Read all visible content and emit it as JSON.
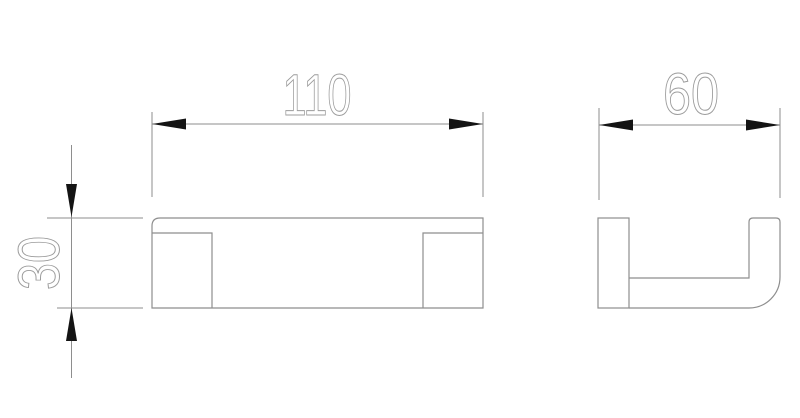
{
  "drawing": {
    "type": "technical-drawing",
    "dimensions": {
      "length": {
        "value": "110"
      },
      "depth": {
        "value": "60"
      },
      "height": {
        "value": "30"
      }
    },
    "colors": {
      "background": "#ffffff",
      "line": "#8e8e8e",
      "dimension_text": "#9c9c9c",
      "arrow": "#141414"
    }
  }
}
